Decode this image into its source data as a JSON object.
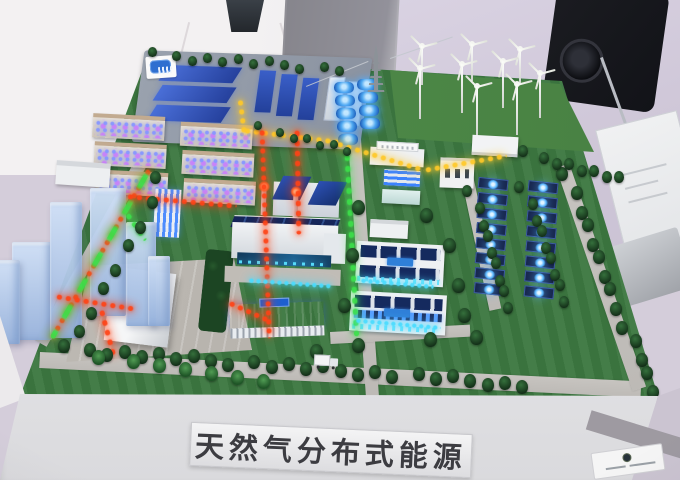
{
  "scene": {
    "type": "photograph",
    "subject": "exhibition scale model of a natural-gas distributed energy park"
  },
  "title_plaque": {
    "text": "天然气分布式能源"
  },
  "colors": {
    "wall": "#f3f1f2",
    "floor": "#d4cdda",
    "panel_gray": "#8b8a91",
    "speaker": "#1a1b20",
    "turf": "#3c7740",
    "turf_light": "#518f4a",
    "road": "#c3c0bc",
    "tree": "#1d4a25",
    "palm": "#2e7a38",
    "pipe_yellow": "#ffc928",
    "pipe_red": "#ff4316",
    "pipe_green": "#3ce04a",
    "led_cyan": "#49dcff",
    "led_blue": "#4fb0ff",
    "roof_blue": "#2c4fb0",
    "stack_glow": "#ff4a1e",
    "solar_panel": "#17264e",
    "city_glass": "#b0c6ea",
    "fascia": "#e9e9ec"
  },
  "counts": {
    "wind_turbines": 9,
    "gas_tanks": 9,
    "residential_blocks": 6,
    "city_towers": 6,
    "solar_field_panels": 16,
    "industrial_blue_roofs": 6,
    "palm_trees": 7
  }
}
